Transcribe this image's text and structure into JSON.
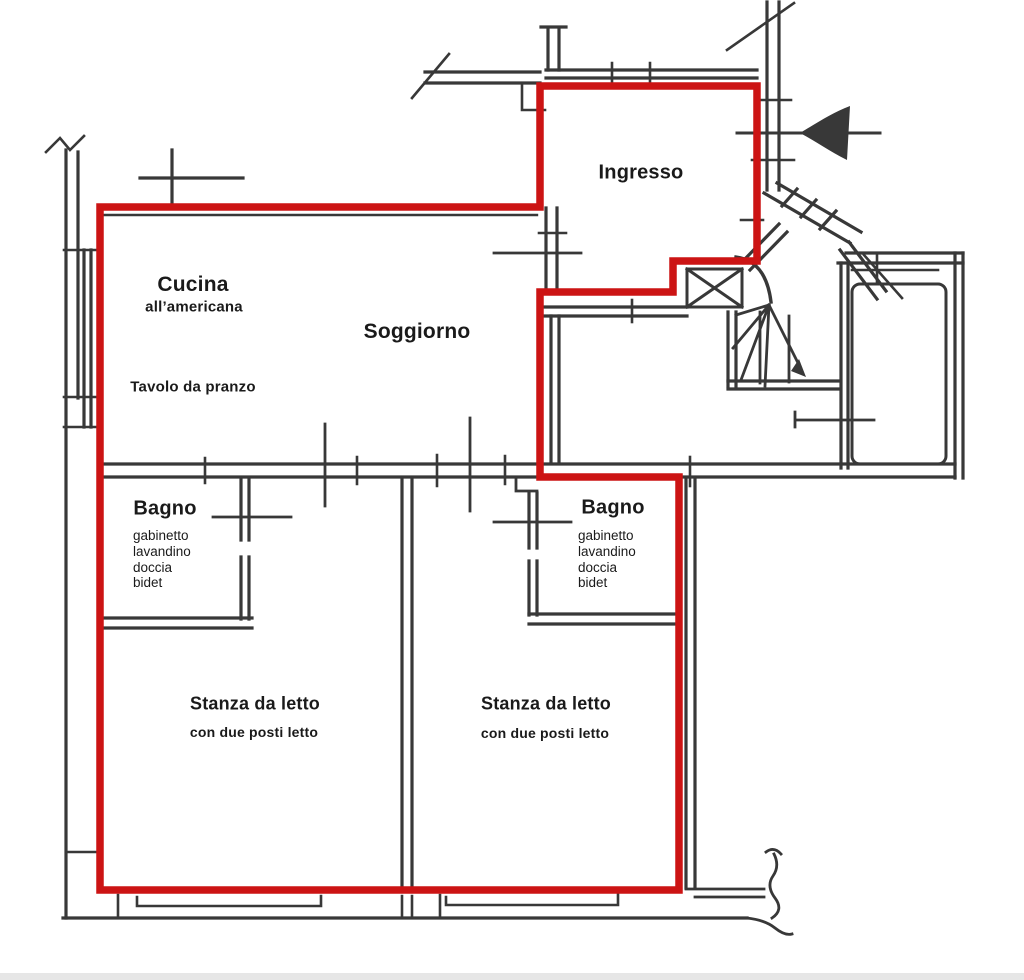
{
  "plan": {
    "title": "Apartment floor plan",
    "highlight_color": "#cc1414",
    "wall_color": "#383838"
  },
  "rooms": {
    "ingresso": {
      "label": "Ingresso"
    },
    "cucina": {
      "label": "Cucina",
      "sublabel": "all’americana"
    },
    "soggiorno": {
      "label": "Soggiorno"
    },
    "tavolo_da_pranzo": {
      "label": "Tavolo da pranzo"
    },
    "bagno_left": {
      "label": "Bagno",
      "features": [
        "gabinetto",
        "lavandino",
        "doccia",
        "bidet"
      ]
    },
    "bagno_right": {
      "label": "Bagno",
      "features": [
        "gabinetto",
        "lavandino",
        "doccia",
        "bidet"
      ]
    },
    "stanza_left": {
      "label": "Stanza da letto",
      "sublabel": "con due posti letto"
    },
    "stanza_right": {
      "label": "Stanza da letto",
      "sublabel": "con due posti letto"
    }
  }
}
